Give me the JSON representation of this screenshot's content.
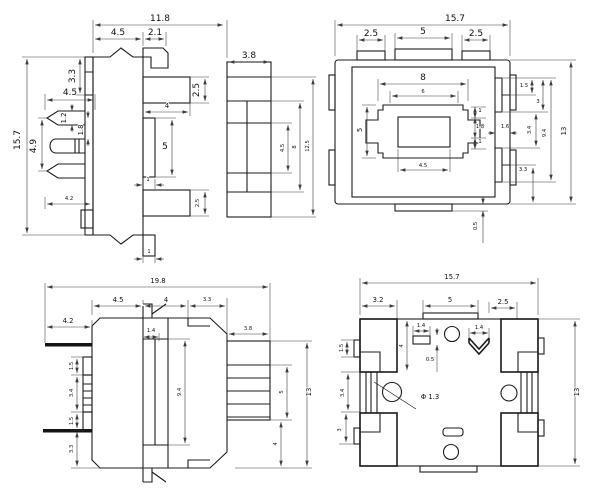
{
  "page": {
    "background": "#ffffff",
    "line_color": "#1c1c1c",
    "dim_color": "#3c3c3c",
    "text_color": "#101010"
  },
  "drawing": {
    "views": [
      {
        "id": "front-view",
        "labels": [
          {
            "text": "11.8",
            "x": 160,
            "y": 21,
            "size": "lg"
          },
          {
            "text": "4.5",
            "x": 118,
            "y": 35,
            "size": "lg"
          },
          {
            "text": "2.1",
            "x": 155,
            "y": 35,
            "size": "lg"
          },
          {
            "text": "3.8",
            "x": 249,
            "y": 58,
            "size": "lg"
          },
          {
            "text": "3.3",
            "x": 75,
            "y": 76,
            "size": "lg",
            "rot": -90
          },
          {
            "text": "4.5",
            "x": 70,
            "y": 95,
            "size": "lg"
          },
          {
            "text": "1.2",
            "x": 66,
            "y": 118,
            "size": "sm",
            "rot": -90
          },
          {
            "text": "1.8",
            "x": 83,
            "y": 130,
            "size": "sm",
            "rot": -90
          },
          {
            "text": "4.9",
            "x": 36,
            "y": 146,
            "size": "lg",
            "rot": -90
          },
          {
            "text": "15.7",
            "x": 20,
            "y": 140,
            "size": "lg",
            "rot": -90
          },
          {
            "text": "4.2",
            "x": 69,
            "y": 200,
            "size": "xs"
          },
          {
            "text": "2.5",
            "x": 199,
            "y": 90,
            "size": "lg",
            "rot": -90
          },
          {
            "text": "4",
            "x": 167,
            "y": 108,
            "size": "sm"
          },
          {
            "text": "5",
            "x": 165,
            "y": 149,
            "size": "lg"
          },
          {
            "text": "1",
            "x": 148,
            "y": 181,
            "size": "xs"
          },
          {
            "text": "2.5",
            "x": 199,
            "y": 203,
            "size": "xs",
            "rot": -90
          },
          {
            "text": "4.5",
            "x": 284,
            "y": 148,
            "size": "xs",
            "rot": -90
          },
          {
            "text": "8",
            "x": 296,
            "y": 147,
            "size": "xs",
            "rot": -90
          },
          {
            "text": "12.5",
            "x": 309,
            "y": 146,
            "size": "xs",
            "rot": -90
          },
          {
            "text": "1",
            "x": 149,
            "y": 253,
            "size": "xs"
          }
        ]
      },
      {
        "id": "top-view",
        "labels": [
          {
            "text": "15.7",
            "x": 455,
            "y": 21,
            "size": "lg"
          },
          {
            "text": "2.5",
            "x": 371,
            "y": 36,
            "size": "lg"
          },
          {
            "text": "5",
            "x": 423,
            "y": 34,
            "size": "lg"
          },
          {
            "text": "2.5",
            "x": 476,
            "y": 36,
            "size": "lg"
          },
          {
            "text": "8",
            "x": 423,
            "y": 80,
            "size": "lg"
          },
          {
            "text": "6",
            "x": 423,
            "y": 93,
            "size": "xs"
          },
          {
            "text": "5",
            "x": 362,
            "y": 130,
            "size": "sm",
            "rot": -90
          },
          {
            "text": "4.5",
            "x": 423,
            "y": 167,
            "size": "xs"
          },
          {
            "text": "1",
            "x": 480,
            "y": 112,
            "size": "xs"
          },
          {
            "text": "1.8",
            "x": 480,
            "y": 128,
            "size": "xs"
          },
          {
            "text": "1",
            "x": 480,
            "y": 143,
            "size": "xs"
          },
          {
            "text": "1.6",
            "x": 505,
            "y": 128,
            "size": "xs"
          },
          {
            "text": "1.5",
            "x": 524,
            "y": 87,
            "size": "xs"
          },
          {
            "text": "3",
            "x": 538,
            "y": 103,
            "size": "xs"
          },
          {
            "text": "3.4",
            "x": 531,
            "y": 130,
            "size": "xs",
            "rot": -90
          },
          {
            "text": "9.4",
            "x": 546,
            "y": 133,
            "size": "xs",
            "rot": -90
          },
          {
            "text": "13",
            "x": 566,
            "y": 131,
            "size": "sm",
            "rot": -90
          },
          {
            "text": "3.3",
            "x": 523,
            "y": 171,
            "size": "xs"
          },
          {
            "text": "0.5",
            "x": 477,
            "y": 226,
            "size": "xs",
            "rot": -90
          }
        ]
      },
      {
        "id": "side-view",
        "labels": [
          {
            "text": "19.8",
            "x": 158,
            "y": 283,
            "size": "sm"
          },
          {
            "text": "4.5",
            "x": 118,
            "y": 302,
            "size": "sm"
          },
          {
            "text": "4",
            "x": 166,
            "y": 302,
            "size": "sm"
          },
          {
            "text": "3.3",
            "x": 207,
            "y": 301,
            "size": "xs"
          },
          {
            "text": "4.2",
            "x": 68,
            "y": 323,
            "size": "sm"
          },
          {
            "text": "1.4",
            "x": 151,
            "y": 332,
            "size": "xs"
          },
          {
            "text": "3.8",
            "x": 248,
            "y": 330,
            "size": "xs"
          },
          {
            "text": "1.5",
            "x": 73,
            "y": 366,
            "size": "xs",
            "rot": -90
          },
          {
            "text": "3.4",
            "x": 73,
            "y": 393,
            "size": "xs",
            "rot": -90
          },
          {
            "text": "1.5",
            "x": 73,
            "y": 421,
            "size": "xs",
            "rot": -90
          },
          {
            "text": "3.3",
            "x": 73,
            "y": 449,
            "size": "xs",
            "rot": -90
          },
          {
            "text": "9.4",
            "x": 181,
            "y": 392,
            "size": "xs",
            "rot": -90
          },
          {
            "text": "5",
            "x": 283,
            "y": 392,
            "size": "xs",
            "rot": -90
          },
          {
            "text": "4",
            "x": 277,
            "y": 444,
            "size": "xs",
            "rot": -90
          },
          {
            "text": "13",
            "x": 311,
            "y": 392,
            "size": "sm",
            "rot": -90
          }
        ]
      },
      {
        "id": "bottom-view",
        "labels": [
          {
            "text": "15.7",
            "x": 452,
            "y": 279,
            "size": "sm"
          },
          {
            "text": "3.2",
            "x": 378,
            "y": 302,
            "size": "sm"
          },
          {
            "text": "5",
            "x": 450,
            "y": 302,
            "size": "sm"
          },
          {
            "text": "2.5",
            "x": 503,
            "y": 304,
            "size": "sm"
          },
          {
            "text": "1.4",
            "x": 421,
            "y": 327,
            "size": "xs"
          },
          {
            "text": "4",
            "x": 403,
            "y": 346,
            "size": "xs",
            "rot": -90
          },
          {
            "text": "0.5",
            "x": 430,
            "y": 361,
            "size": "xs"
          },
          {
            "text": "1.4",
            "x": 479,
            "y": 329,
            "size": "xs"
          },
          {
            "text": "Φ 1.3",
            "x": 430,
            "y": 399,
            "size": "sm"
          },
          {
            "text": "1.5",
            "x": 343,
            "y": 348,
            "size": "xs",
            "rot": -90
          },
          {
            "text": "3.4",
            "x": 344,
            "y": 393,
            "size": "xs",
            "rot": -90
          },
          {
            "text": "3",
            "x": 341,
            "y": 430,
            "size": "xs",
            "rot": -90
          },
          {
            "text": "13",
            "x": 579,
            "y": 392,
            "size": "sm",
            "rot": -90
          }
        ]
      }
    ]
  }
}
